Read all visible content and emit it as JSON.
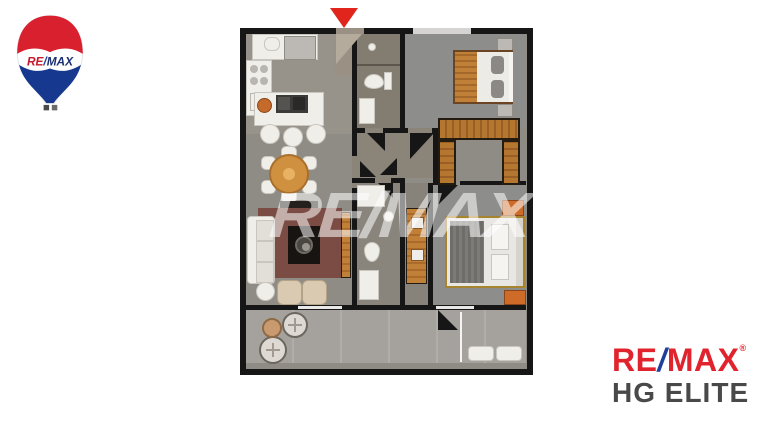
{
  "watermark": {
    "text": "RE/MAX"
  },
  "balloon_logo": {
    "re": "RE",
    "slash": "/",
    "max": "MAX"
  },
  "corner_logo": {
    "re": "RE",
    "slash": "/",
    "max": "MAX",
    "registered": "®",
    "subbrand": "HG ELITE"
  },
  "entrance_marker": {
    "type": "triangle-down",
    "color": "#e1251c"
  },
  "colors": {
    "background": "#ffffff",
    "remax_red": "#e0232d",
    "remax_blue": "#1f3f9a",
    "subbrand_gray": "#494949",
    "marker_red": "#e1251c",
    "wall_black": "#161616",
    "floor_gray": "#8f8c86",
    "balcony_gray": "#a5a29d",
    "wood_orange": "#b5762f",
    "rug_maroon": "#7b4c44",
    "furniture_white": "#f0eee9",
    "armchair_beige": "#d9cab1"
  }
}
